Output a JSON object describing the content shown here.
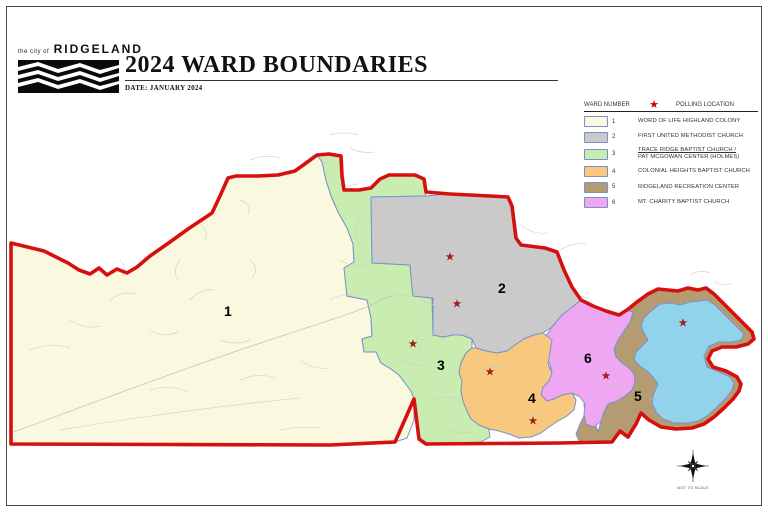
{
  "header": {
    "logo_small": "the city of",
    "logo_name": "RIDGELAND",
    "title": "2024 WARD BOUNDARIES",
    "date_line": "DATE: JANUARY 2024"
  },
  "legend": {
    "col1_header": "WARD NUMBER",
    "col2_header": "POLLING LOCATION",
    "star_icon": "★",
    "items": [
      {
        "number": "1",
        "color": "#FAF8DE",
        "name": "WORD OF LIFE HIGHLAND COLONY",
        "name2": ""
      },
      {
        "number": "2",
        "color": "#CACACA",
        "name": "FIRST UNITED METHODIST CHURCH",
        "name2": ""
      },
      {
        "number": "3",
        "color": "#C9ECB0",
        "name": "TRACE RIDGE BAPTIST CHURCH /",
        "name2": "PAT MCGOWAN CENTER (HOLMES)"
      },
      {
        "number": "4",
        "color": "#F7C87D",
        "name": "COLONIAL HEIGHTS BAPTIST CHURCH",
        "name2": ""
      },
      {
        "number": "5",
        "color": "#B59B72",
        "name": "RIDGELAND RECREATION CENTER",
        "name2": ""
      },
      {
        "number": "6",
        "color": "#EFA7F1",
        "name": "MT. CHARITY BAPTIST CHURCH",
        "name2": ""
      }
    ]
  },
  "map": {
    "colors": {
      "ward1": "#FAF8DE",
      "ward2": "#CACACA",
      "ward3": "#C9ECB0",
      "ward4": "#F7C87D",
      "ward5": "#B59B72",
      "ward6": "#EFA7F1",
      "water": "#90D3EB",
      "boundary": "#D6100F"
    },
    "ward_labels": [
      {
        "text": "1",
        "x": 224,
        "y": 316
      },
      {
        "text": "2",
        "x": 498,
        "y": 293
      },
      {
        "text": "3",
        "x": 437,
        "y": 370
      },
      {
        "text": "4",
        "x": 528,
        "y": 403
      },
      {
        "text": "5",
        "x": 634,
        "y": 401
      },
      {
        "text": "6",
        "x": 584,
        "y": 363
      }
    ],
    "polling_stars": [
      {
        "x": 450,
        "y": 256
      },
      {
        "x": 457,
        "y": 303
      },
      {
        "x": 413,
        "y": 343
      },
      {
        "x": 490,
        "y": 371
      },
      {
        "x": 533,
        "y": 420
      },
      {
        "x": 606,
        "y": 375
      },
      {
        "x": 683,
        "y": 322
      }
    ],
    "compass_caption": "NOT TO SCALE"
  }
}
